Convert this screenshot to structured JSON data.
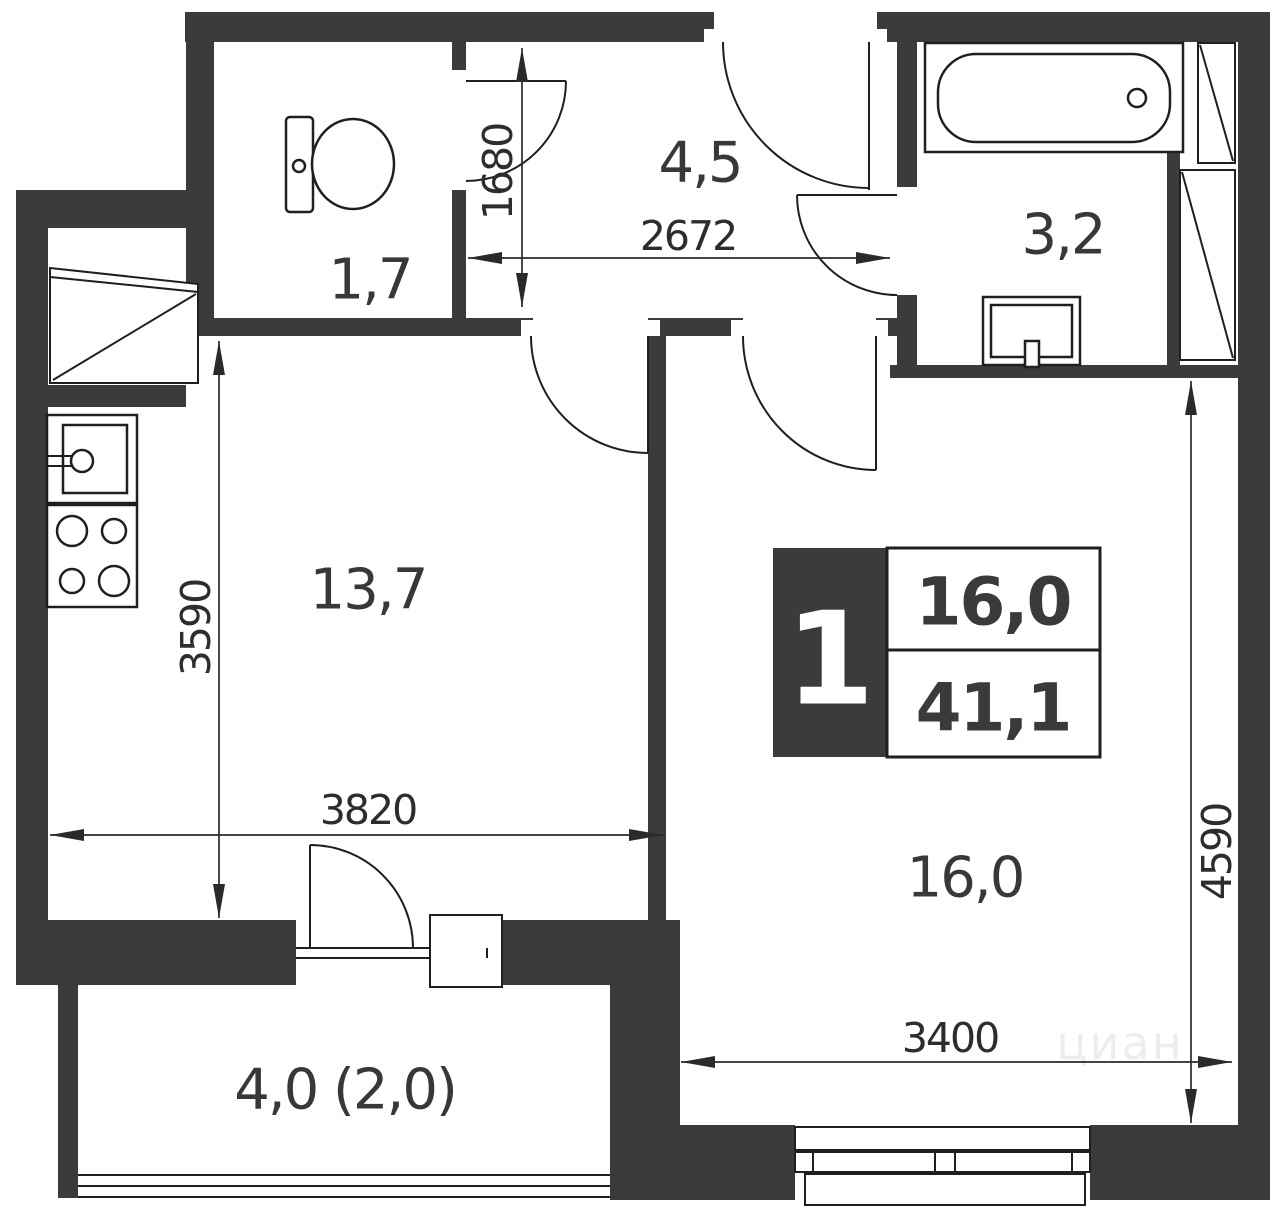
{
  "plan": {
    "badge": {
      "rooms": "1",
      "living_area": "16,0",
      "total_area": "41,1"
    },
    "rooms": [
      {
        "name": "toilet",
        "area": "1,7"
      },
      {
        "name": "hallway",
        "area": "4,5"
      },
      {
        "name": "bathroom",
        "area": "3,2"
      },
      {
        "name": "kitchen",
        "area": "13,7"
      },
      {
        "name": "living-room",
        "area": "16,0"
      },
      {
        "name": "balcony",
        "area": "4,0 (2,0)"
      }
    ],
    "dimensions": [
      {
        "name": "hallway-depth",
        "value": "1680"
      },
      {
        "name": "hallway-width",
        "value": "2672"
      },
      {
        "name": "kitchen-depth",
        "value": "3590"
      },
      {
        "name": "kitchen-width",
        "value": "3820"
      },
      {
        "name": "room-depth",
        "value": "4590"
      },
      {
        "name": "room-width",
        "value": "3400"
      }
    ],
    "watermark": "циан",
    "colors": {
      "wall": "#3b3b3b",
      "line": "#1f1f1f",
      "label": "#383838",
      "background": "#ffffff"
    }
  }
}
